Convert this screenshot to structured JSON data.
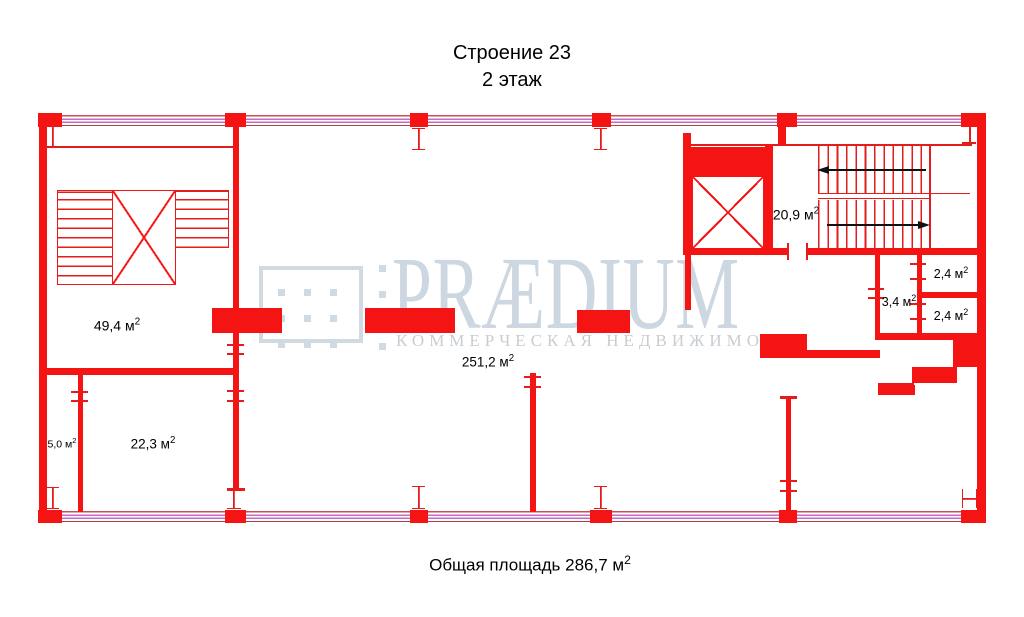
{
  "title": {
    "building": "Строение 23",
    "floor": "2 этаж"
  },
  "footer": {
    "label": "Общая площадь 286,7 м",
    "sup": "2"
  },
  "watermark": {
    "brand": "PRÆDIUM",
    "tagline": "КОММЕРЧЕСКАЯ НЕДВИЖИМОСТЬ"
  },
  "rooms": [
    {
      "name": "stairwell-left",
      "area": "49,4 м",
      "sup": "2"
    },
    {
      "name": "small-room",
      "area": "5,0 м",
      "sup": "2"
    },
    {
      "name": "office-room",
      "area": "22,3 м",
      "sup": "2"
    },
    {
      "name": "open-space",
      "area": "251,2 м",
      "sup": "2"
    },
    {
      "name": "stairwell-right",
      "area": "20,9 м",
      "sup": "2"
    },
    {
      "name": "wc-lobby",
      "area": "3,4 м",
      "sup": "2"
    },
    {
      "name": "wc-top",
      "area": "2,4 м",
      "sup": "2"
    },
    {
      "name": "wc-bottom",
      "area": "2,4 м",
      "sup": "2"
    }
  ],
  "colors": {
    "plan_red": "#f41414",
    "line_red": "#e41c1c",
    "window_red": "#c85050",
    "window_violet": "#c46cc4",
    "watermark_blue": "#ccd7e1",
    "arrow_black": "#111111"
  }
}
